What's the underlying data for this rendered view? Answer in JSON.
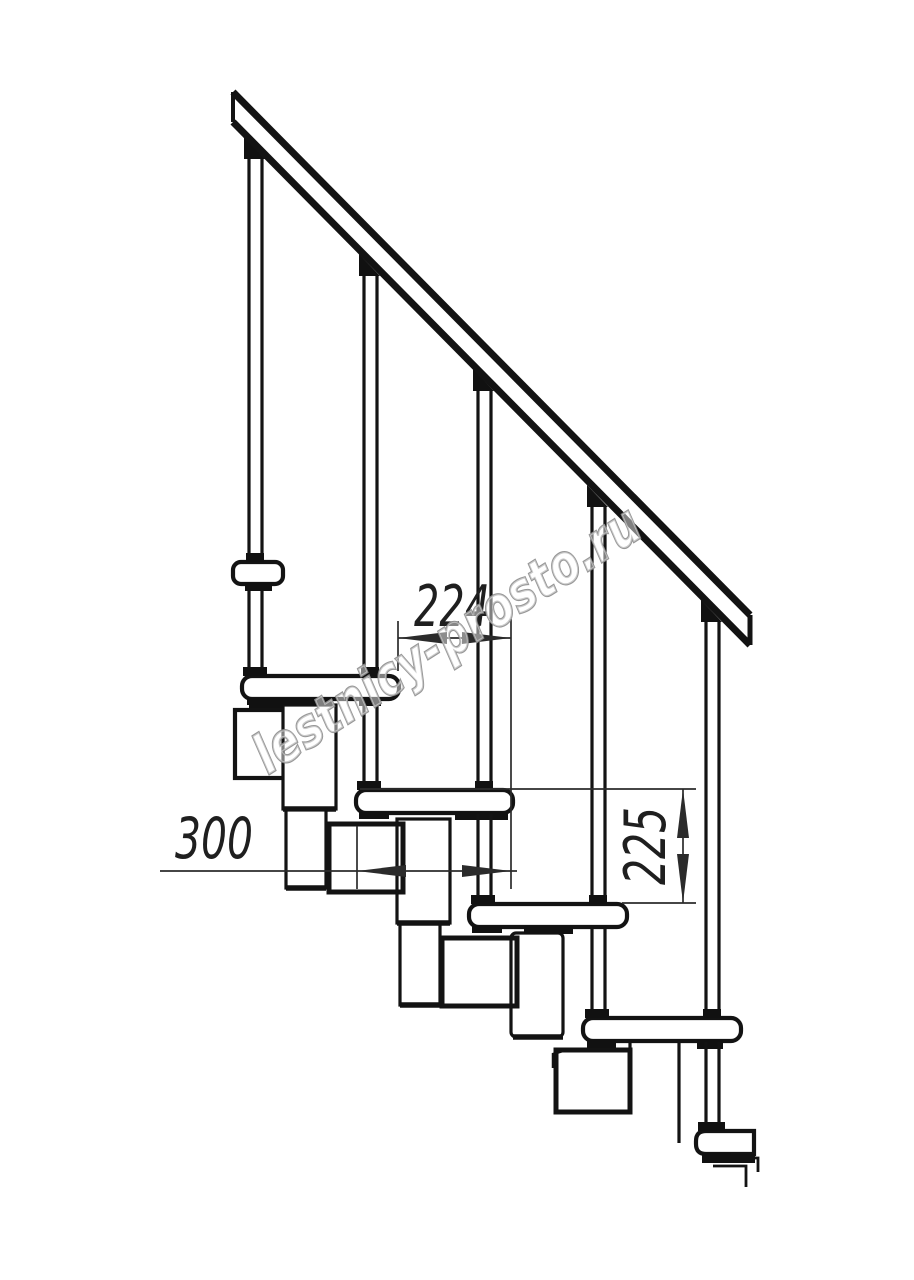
{
  "watermark": {
    "text": "lestnicy-prosto.ru",
    "color": "#8f8f8f"
  },
  "dimensions": {
    "going": {
      "value": "224",
      "orientation": "horizontal"
    },
    "tread_depth": {
      "value": "300",
      "orientation": "horizontal"
    },
    "rise": {
      "value": "225",
      "orientation": "vertical"
    }
  },
  "drawing": {
    "type": "technical elevation (side view)",
    "subject": "modular staircase fragment",
    "baluster_count": 5,
    "tread_count": 6,
    "colors": {
      "line": "#131313",
      "dimension_line": "#2b2b2b",
      "background": "#ffffff"
    }
  }
}
